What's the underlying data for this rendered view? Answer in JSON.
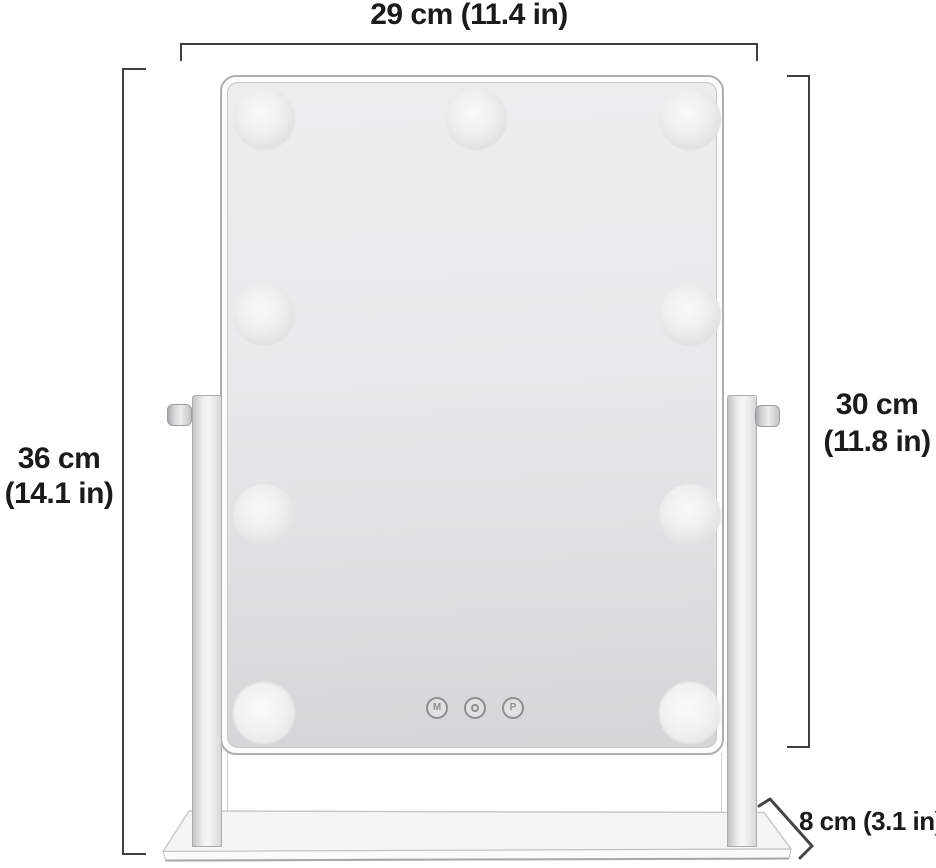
{
  "annotations": {
    "width": {
      "label": "29 cm (11.4 in)"
    },
    "total_height": {
      "line1": "36 cm",
      "line2": "(14.1 in)"
    },
    "mirror_height": {
      "line1": "30 cm",
      "line2": "(11.8 in)"
    },
    "depth": {
      "label": "8 cm (3.1 in)"
    }
  },
  "mirror": {
    "bulb_count": 9,
    "buttons": [
      {
        "id": "m",
        "label": "M"
      },
      {
        "id": "power",
        "icon": "power-icon"
      },
      {
        "id": "p",
        "label": "P"
      }
    ]
  },
  "colors": {
    "text": "#1b1b1c",
    "dimension_line": "#3f3f3f",
    "glass_top": "#ededee",
    "glass_bottom": "#d3d5d6"
  }
}
